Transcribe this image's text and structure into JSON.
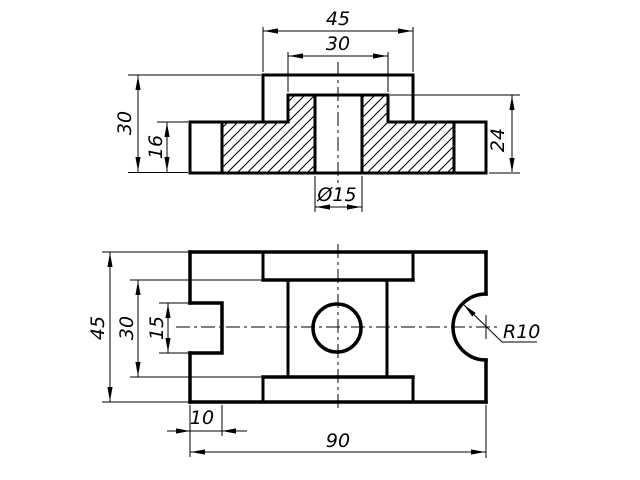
{
  "colors": {
    "background": "#ffffff",
    "ink": "#000000"
  },
  "front_view": {
    "name": "front section view",
    "labels": {
      "top_width": "45",
      "boss_width": "30",
      "total_height": "30",
      "flange_height": "16",
      "boss_height": "24",
      "hole_dia": "Ø15"
    }
  },
  "plan_view": {
    "name": "plan view",
    "labels": {
      "total_depth": "45",
      "boss_depth": "30",
      "notch_width": "15",
      "notch_depth": "10",
      "total_length": "90",
      "scallop_radius": "R10"
    }
  }
}
